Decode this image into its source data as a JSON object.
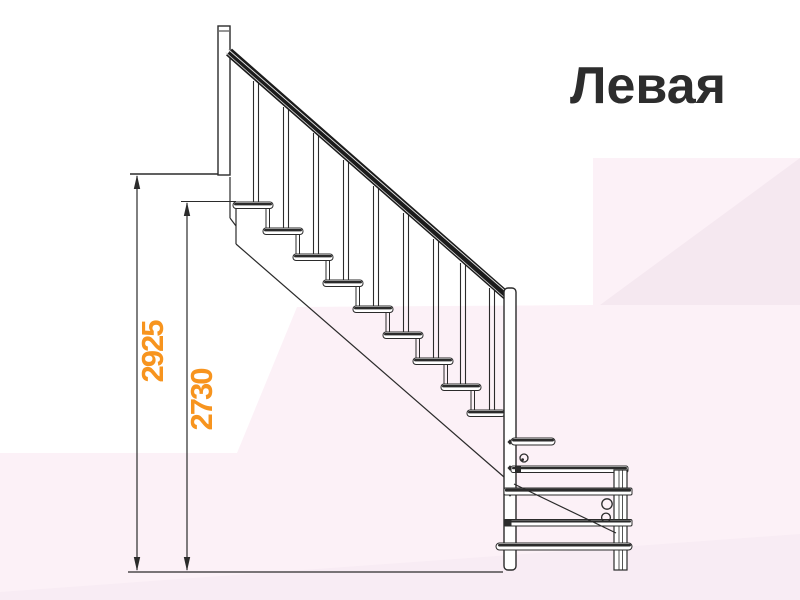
{
  "title": "Левая",
  "dimensions": {
    "total_height": "2925",
    "upper_height": "2730"
  },
  "colors": {
    "accent_orange": "#F7941E",
    "line_dark": "#2B2B2B",
    "handrail_black": "#1B1B1B",
    "bg_pink_light": "#FCF1F7",
    "bg_pink_dark": "#F5E8F0",
    "bg_pink_strip": "#F8ECF4",
    "title_color": "#2D2D2D"
  },
  "drawing": {
    "steps_count": 9,
    "balusters_count": 9,
    "orientation_label": "Левая"
  }
}
